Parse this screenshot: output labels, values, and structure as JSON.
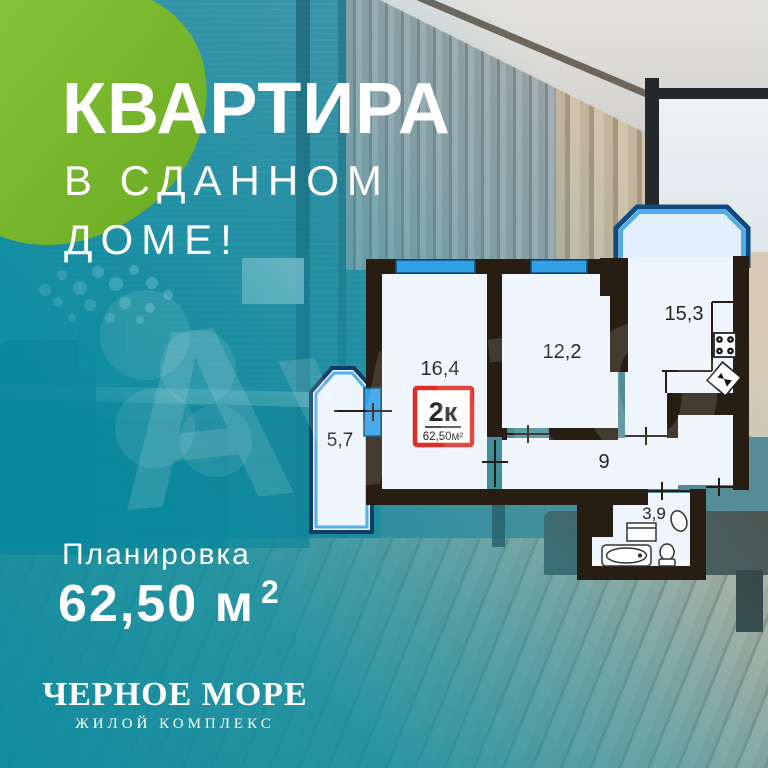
{
  "ad": {
    "headline": "КВАРТИРА",
    "subheadline_line1": "В СДАННОМ",
    "subheadline_line2": "ДОМЕ!",
    "plan_label": "Планировка",
    "area_value": "62,50 м",
    "area_sup": "2"
  },
  "floorplan": {
    "badge": {
      "rooms": "2к",
      "area": "62,50м²"
    },
    "rooms": [
      {
        "name": "living-room",
        "area": "16,4"
      },
      {
        "name": "bedroom",
        "area": "12,2"
      },
      {
        "name": "kitchen",
        "area": "15,3"
      },
      {
        "name": "balcony",
        "area": "5,7"
      },
      {
        "name": "hallway",
        "area": "9"
      },
      {
        "name": "bathroom",
        "area": "3,9"
      }
    ]
  },
  "brand": {
    "name": "ЧЕРНОЕ МОРЕ",
    "tagline": "ЖИЛОЙ КОМПЛЕКС"
  },
  "watermark": "Avito",
  "palette": {
    "accent_green": "#76b52b",
    "overlay_teal": "#0d93a8",
    "wall": "#281d12",
    "room_fill": "#eff5fc",
    "window_blue": "#2f9fe6",
    "badge_red": "#dc2e26"
  }
}
